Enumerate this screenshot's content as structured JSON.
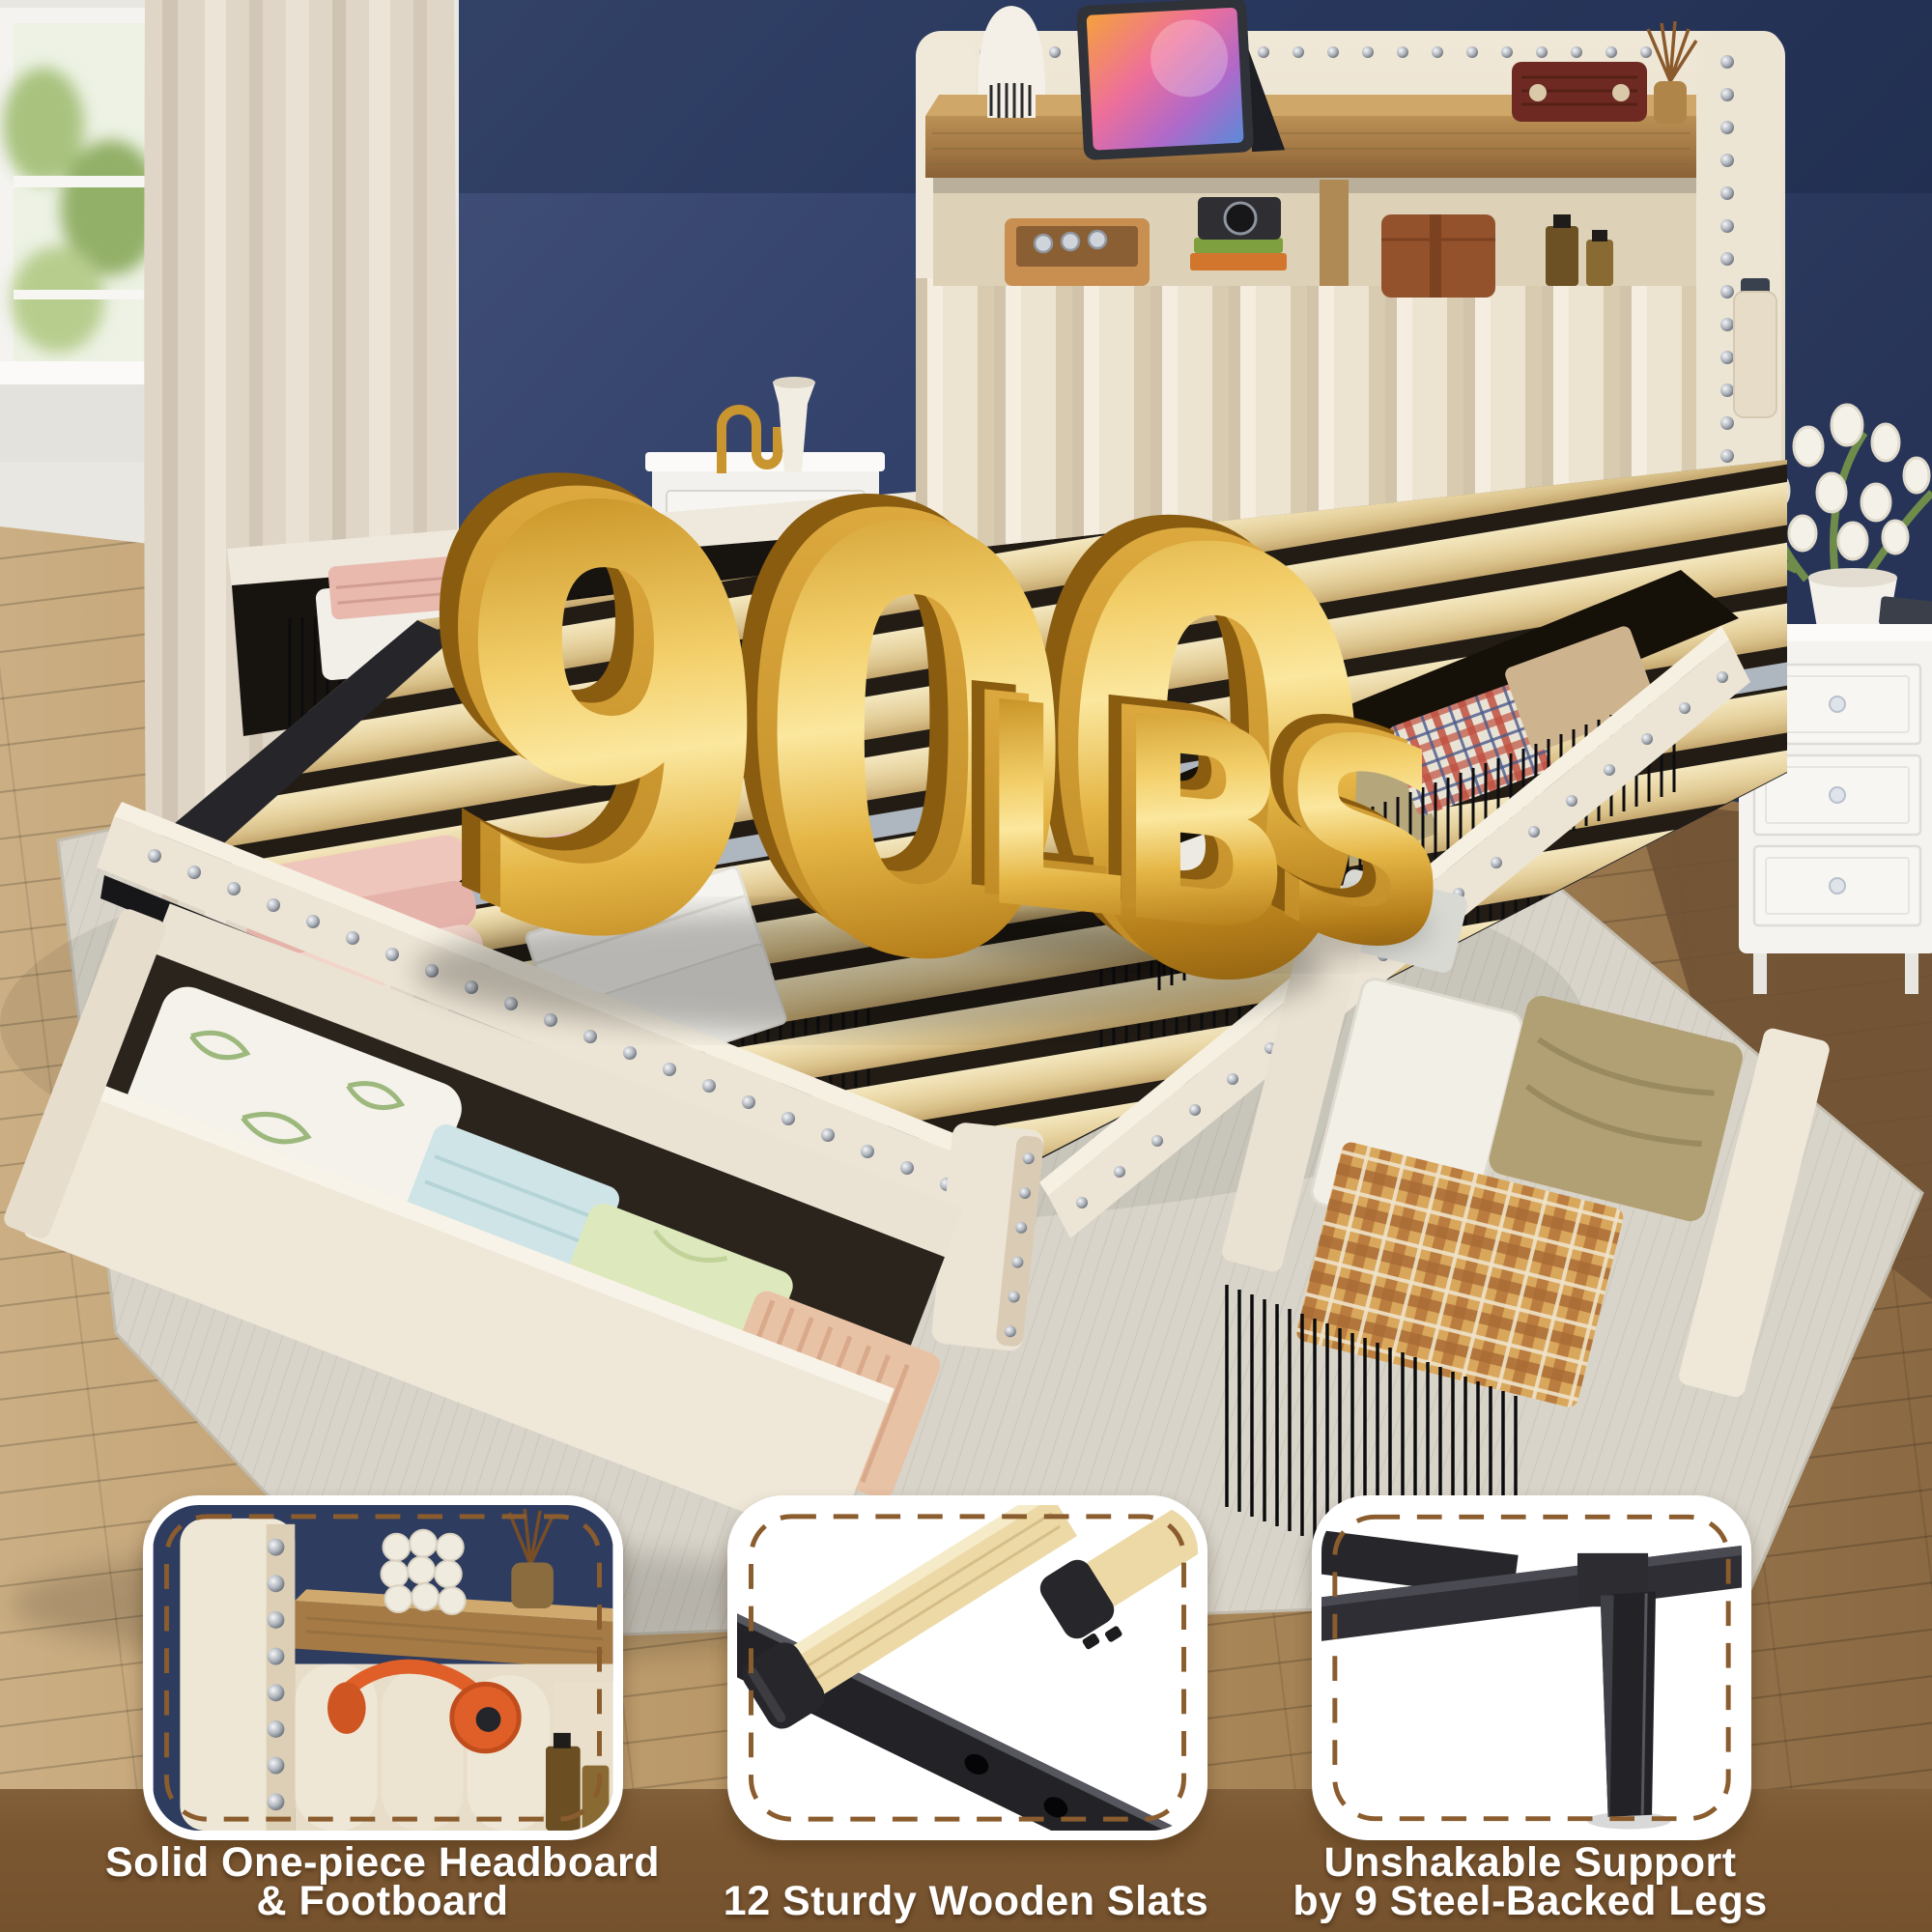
{
  "overlay": {
    "weight_value": "900",
    "weight_unit": "LBS"
  },
  "feature_cards": [
    {
      "id": "headboard",
      "caption_lines": [
        "Solid One-piece Headboard",
        "& Footboard"
      ]
    },
    {
      "id": "wooden-slats",
      "caption_lines": [
        "12 Sturdy Wooden Slats"
      ]
    },
    {
      "id": "steel-legs",
      "caption_lines": [
        "Unshakable Support",
        "by 9 Steel-Backed Legs"
      ]
    }
  ],
  "palette": {
    "band_brown": "#7b5731",
    "dash_brown": "#8a5c2e",
    "card_border": "#ffffff",
    "caption_text": "#ffffff",
    "gold_light": "#fbe79e",
    "gold_mid": "#e2ab36",
    "gold_dark": "#8a5e10",
    "wall_navy": "#33436b",
    "headboard_cream": "#ece3d0",
    "slat_wood": "#e9d6a4",
    "steel_black": "#232327",
    "rug_gray": "#d8d4ca",
    "floor_wood": "#b3905f"
  }
}
